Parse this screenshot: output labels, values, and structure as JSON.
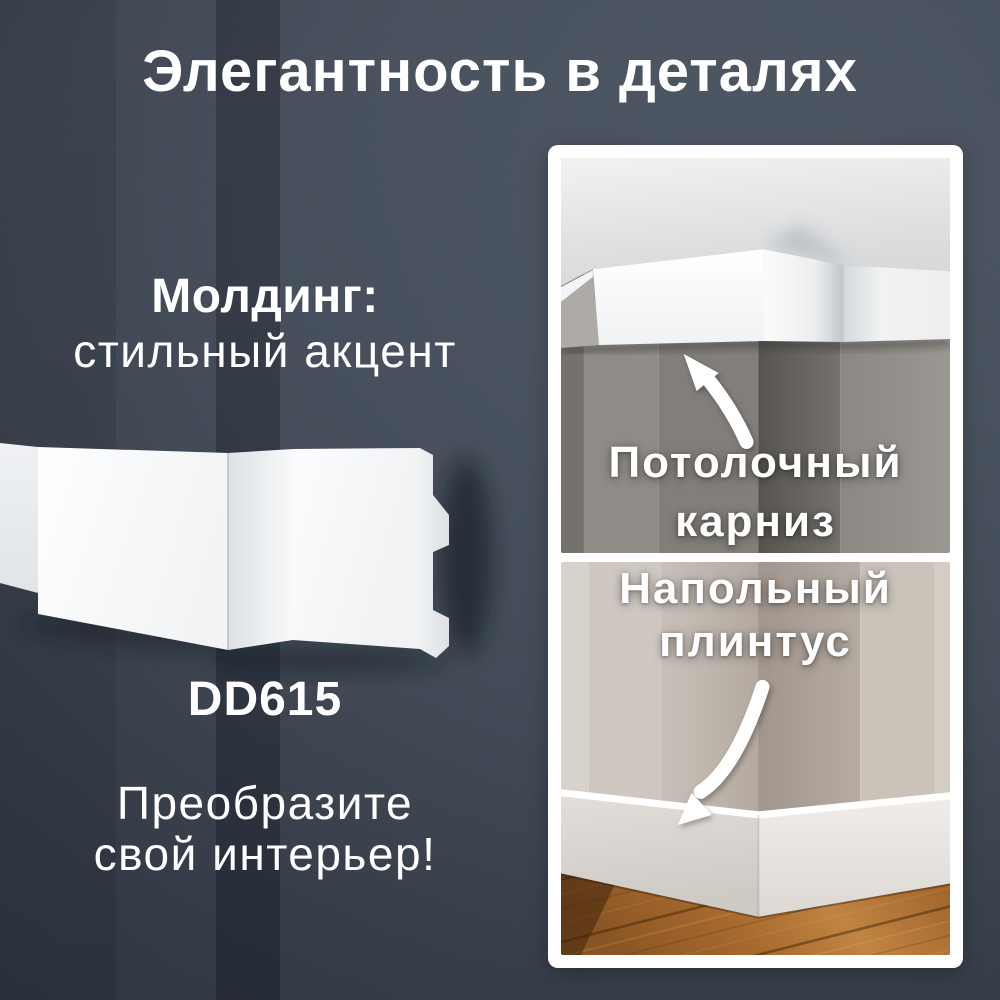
{
  "header": {
    "title": "Элегантность в деталях"
  },
  "product": {
    "tagline_bold": "Молдинг:",
    "tagline_light": "стильный акцент",
    "code": "DD615",
    "cta_line1": "Преобразите",
    "cta_line2": "свой интерьер!"
  },
  "panel": {
    "cards": [
      {
        "label_line1": "Потолочный",
        "label_line2": "карниз",
        "icon": "arrow-curved-up-left-icon"
      },
      {
        "label_line1": "Напольный",
        "label_line2": "плинтус",
        "icon": "arrow-curved-down-left-icon"
      }
    ]
  },
  "colors": {
    "background_dark": "#333b47",
    "background_stripe": "#2b323d",
    "text_light": "#ffffff",
    "panel_frame": "#ffffff",
    "molding_white": "#f7f8f9",
    "wall_taupe": "#86827e",
    "wall_greige": "#c6beb6",
    "wood_floor": "#a86a2e"
  }
}
